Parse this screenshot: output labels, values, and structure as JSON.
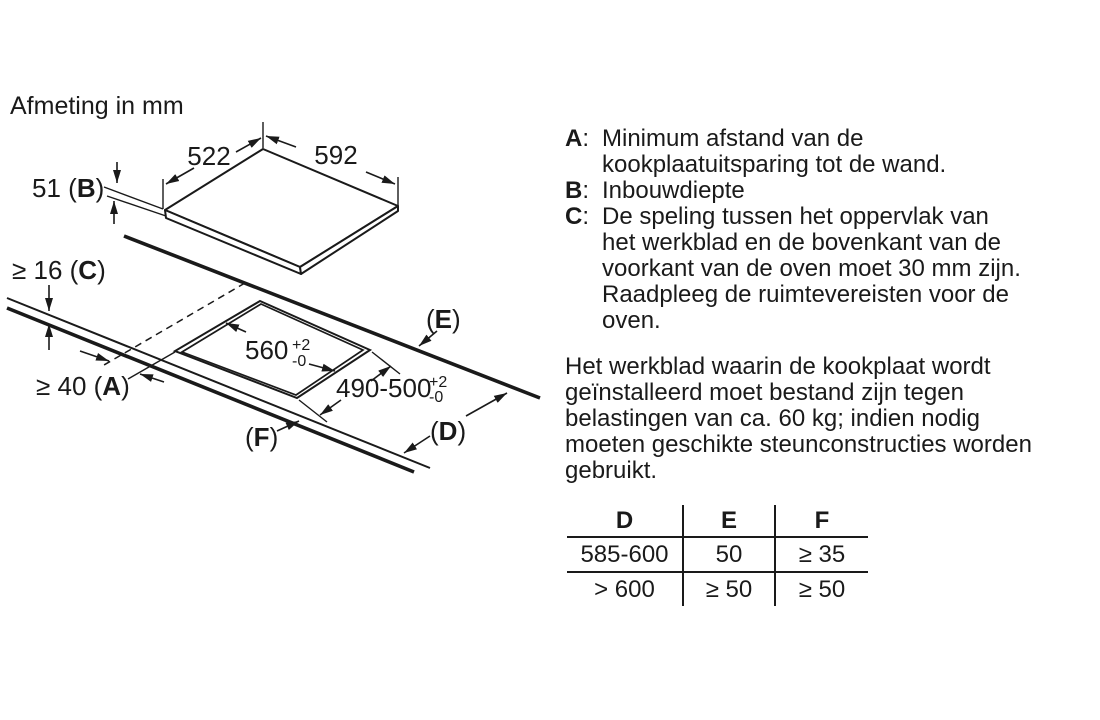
{
  "colors": {
    "ink": "#1a1a1a",
    "background": "#ffffff"
  },
  "title": "Afmeting in mm",
  "colon": ":",
  "diagram": {
    "d522": "522",
    "d592": "592",
    "b": {
      "pre": "51 (",
      "letter": "B",
      "post": ")"
    },
    "c": {
      "pre": "≥ 16 (",
      "letter": "C",
      "post": ")"
    },
    "a": {
      "pre": "≥ 40 (",
      "letter": "A",
      "post": ")"
    },
    "e": {
      "pre": "(",
      "letter": "E",
      "post": ")"
    },
    "d": {
      "pre": "(",
      "letter": "D",
      "post": ")"
    },
    "f": {
      "pre": "(",
      "letter": "F",
      "post": ")"
    },
    "cutout_width": {
      "value": "560",
      "tol_plus": "+2",
      "tol_minus": "-0"
    },
    "cutout_depth": {
      "value": "490-500",
      "tol_plus": "+2",
      "tol_minus": "-0"
    }
  },
  "defs": [
    {
      "label": "A",
      "lines": [
        "Minimum afstand van de",
        "kookplaatuitsparing tot de wand."
      ]
    },
    {
      "label": "B",
      "lines": [
        "Inbouwdiepte"
      ]
    },
    {
      "label": "C",
      "lines": [
        "De speling tussen het oppervlak van",
        "het werkblad en de bovenkant van de",
        "voorkant van de oven moet 30 mm zijn.",
        "Raadpleeg de ruimtevereisten voor de",
        "oven."
      ]
    }
  ],
  "paragraph": [
    "Het werkblad waarin de kookplaat wordt",
    "geïnstalleerd moet bestand zijn tegen",
    "belastingen van ca. 60 kg; indien nodig",
    "moeten geschikte steunconstructies worden",
    "gebruikt."
  ],
  "table": {
    "headers": [
      "D",
      "E",
      "F"
    ],
    "rows": [
      [
        "585-600",
        "50",
        "≥ 35"
      ],
      [
        "> 600",
        "≥ 50",
        "≥ 50"
      ]
    ]
  }
}
